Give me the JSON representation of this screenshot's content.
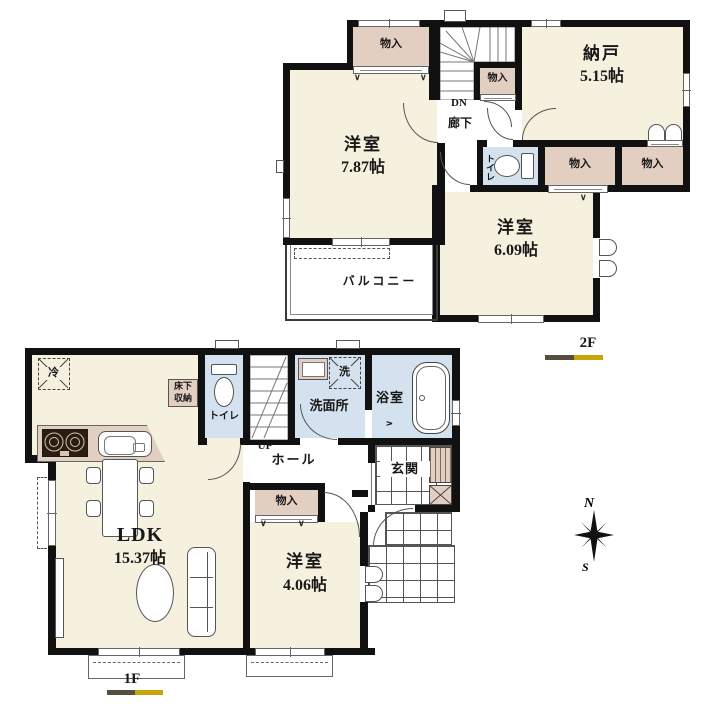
{
  "colors": {
    "wall": "#111111",
    "room_cream": "#f6f0df",
    "closet_pink": "#e3cec2",
    "wet_blue": "#d3e2ee",
    "accent_gold": "#c7a408",
    "accent_dark": "#574e42"
  },
  "icons": {
    "fold_mark": "∨",
    "fold_mark_right": ">"
  },
  "compass": {
    "north": "N",
    "south": "S"
  },
  "f2": {
    "label": "2F",
    "storage_top": "物入",
    "storage_small": "物入",
    "storage_left": "物入",
    "storage_right": "物入",
    "nando_name": "納戸",
    "nando_size": "5.15帖",
    "west_room_name": "洋室",
    "west_room_size": "7.87帖",
    "east_room_name": "洋室",
    "east_room_size": "6.09帖",
    "toilet": "トイレ",
    "hallway": "廊下",
    "stairs_dn": "DN",
    "balcony": "バルコニー"
  },
  "f1": {
    "label": "1F",
    "fridge": "冷",
    "underfloor_l1": "床下",
    "underfloor_l2": "収納",
    "toilet": "トイレ",
    "stairs_up": "UP",
    "washer": "洗",
    "washroom": "洗面所",
    "bathroom": "浴室",
    "hall": "ホール",
    "entrance": "玄関",
    "storage": "物入",
    "ldk_name": "LDK",
    "ldk_size": "15.37帖",
    "south_room_name": "洋室",
    "south_room_size": "4.06帖"
  }
}
